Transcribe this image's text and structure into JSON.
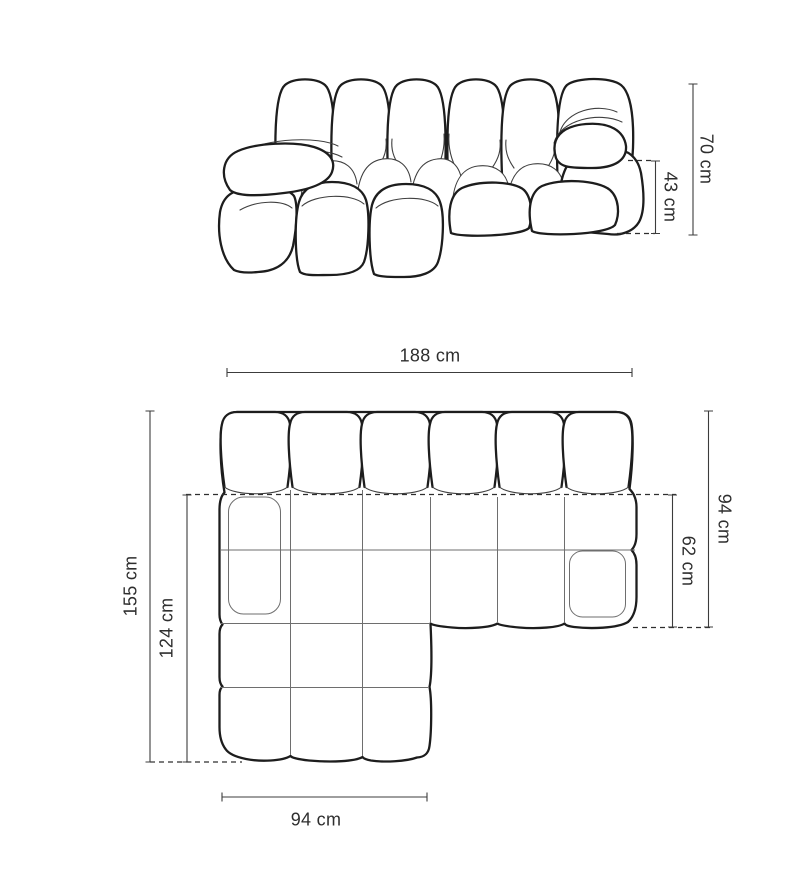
{
  "dims": {
    "side_height_total": "70 cm",
    "side_seat_height": "43 cm",
    "top_width_total": "188 cm",
    "top_depth_total": "94 cm",
    "top_seat_depth": "62 cm",
    "top_chaise_depth_total": "155 cm",
    "top_chaise_depth_inner": "124 cm",
    "top_chaise_width": "94 cm"
  },
  "colors": {
    "background": "#ffffff",
    "outline_ink": "#1d1d1d",
    "thin_line": "#3f3f3f",
    "grid_line": "#6e6e6e",
    "label_text": "#2e2e2e"
  }
}
